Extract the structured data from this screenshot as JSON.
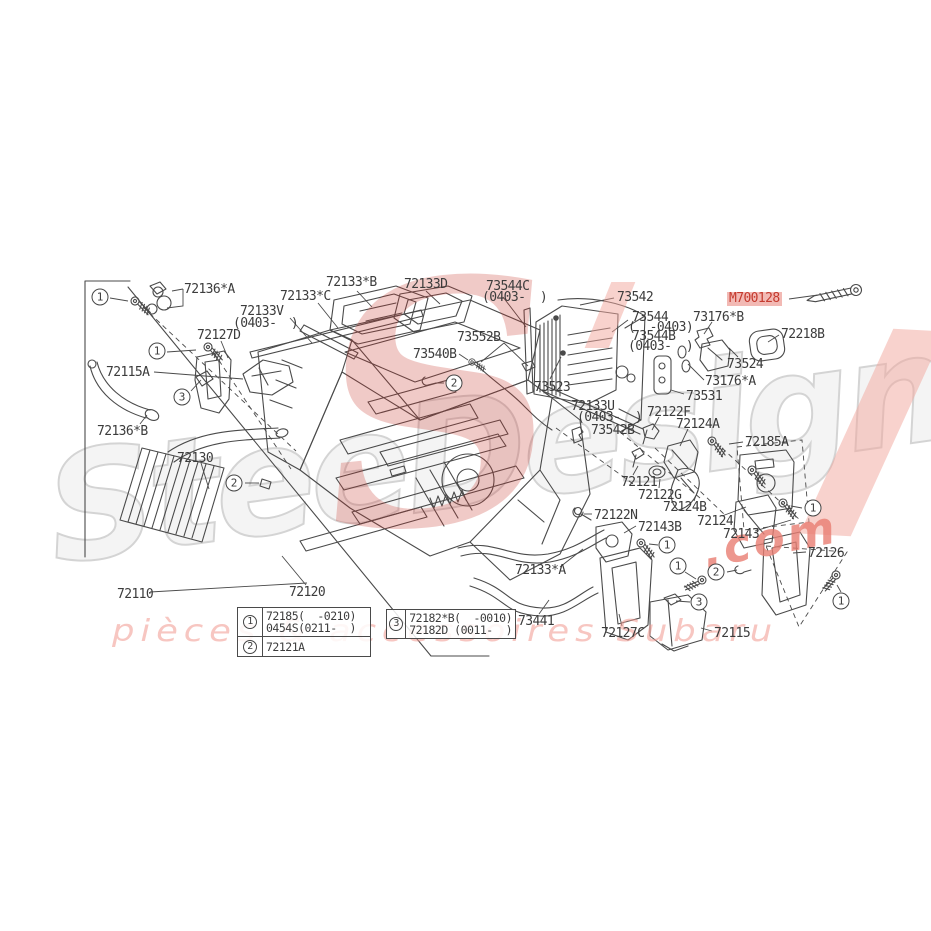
{
  "diagram": {
    "bg": "#ffffff",
    "line_color": "#4a4a4a",
    "label_color": "#3c3c3c",
    "highlight": {
      "part": "M700128",
      "text_color": "#c43a2e",
      "bg_color": "#f2b9b4"
    },
    "part_labels": [
      {
        "text": "72136*A",
        "x": 184,
        "y": 283
      },
      {
        "text": "72133*C",
        "x": 280,
        "y": 290
      },
      {
        "text": "72133*B",
        "x": 326,
        "y": 276
      },
      {
        "text": "72133D",
        "x": 404,
        "y": 278
      },
      {
        "text": "72133V",
        "x": 240,
        "y": 305
      },
      {
        "text": "(0403-  )",
        "x": 233,
        "y": 317
      },
      {
        "text": "72127D",
        "x": 197,
        "y": 329
      },
      {
        "text": "72115A",
        "x": 106,
        "y": 366
      },
      {
        "text": "72136*B",
        "x": 97,
        "y": 425
      },
      {
        "text": "72130",
        "x": 177,
        "y": 452
      },
      {
        "text": "72110",
        "x": 117,
        "y": 588
      },
      {
        "text": "72120",
        "x": 289,
        "y": 586
      },
      {
        "text": "73544C",
        "x": 486,
        "y": 280
      },
      {
        "text": "(0403-  )",
        "x": 482,
        "y": 291
      },
      {
        "text": "73542",
        "x": 617,
        "y": 291
      },
      {
        "text": "73552B",
        "x": 457,
        "y": 331
      },
      {
        "text": "73540B",
        "x": 413,
        "y": 348
      },
      {
        "text": "73523",
        "x": 534,
        "y": 381
      },
      {
        "text": "72133U",
        "x": 571,
        "y": 400
      },
      {
        "text": "(0403-  )",
        "x": 577,
        "y": 411
      },
      {
        "text": "73542B",
        "x": 591,
        "y": 424
      },
      {
        "text": "M700128",
        "x": 727,
        "y": 292,
        "highlight": true
      },
      {
        "text": "72218B",
        "x": 781,
        "y": 328
      },
      {
        "text": "73544",
        "x": 632,
        "y": 311
      },
      {
        "text": "(  -0403)",
        "x": 628,
        "y": 321
      },
      {
        "text": "73544B",
        "x": 632,
        "y": 330
      },
      {
        "text": "(0403-  )",
        "x": 628,
        "y": 340
      },
      {
        "text": "73176*B",
        "x": 693,
        "y": 311
      },
      {
        "text": "73524",
        "x": 727,
        "y": 358
      },
      {
        "text": "73176*A",
        "x": 705,
        "y": 375
      },
      {
        "text": "73531",
        "x": 686,
        "y": 390
      },
      {
        "text": "72122F",
        "x": 647,
        "y": 406
      },
      {
        "text": "72124A",
        "x": 676,
        "y": 418
      },
      {
        "text": "72185A",
        "x": 745,
        "y": 436
      },
      {
        "text": "72121",
        "x": 621,
        "y": 476
      },
      {
        "text": "72122G",
        "x": 638,
        "y": 489
      },
      {
        "text": "72124B",
        "x": 663,
        "y": 501
      },
      {
        "text": "72124",
        "x": 697,
        "y": 515
      },
      {
        "text": "72143",
        "x": 723,
        "y": 528
      },
      {
        "text": "72122N",
        "x": 594,
        "y": 509
      },
      {
        "text": "72143B",
        "x": 638,
        "y": 521
      },
      {
        "text": "72126",
        "x": 808,
        "y": 547
      },
      {
        "text": "72133*A",
        "x": 515,
        "y": 564
      },
      {
        "text": "73441",
        "x": 518,
        "y": 615
      },
      {
        "text": "72127C",
        "x": 601,
        "y": 627
      },
      {
        "text": "72115",
        "x": 714,
        "y": 627
      }
    ],
    "callouts": [
      {
        "num": "1",
        "x": 100,
        "y": 297
      },
      {
        "num": "1",
        "x": 157,
        "y": 351
      },
      {
        "num": "3",
        "x": 182,
        "y": 397
      },
      {
        "num": "2",
        "x": 234,
        "y": 483
      },
      {
        "num": "2",
        "x": 454,
        "y": 383
      },
      {
        "num": "1",
        "x": 813,
        "y": 508
      },
      {
        "num": "1",
        "x": 667,
        "y": 545
      },
      {
        "num": "1",
        "x": 678,
        "y": 566
      },
      {
        "num": "2",
        "x": 716,
        "y": 572
      },
      {
        "num": "3",
        "x": 699,
        "y": 602
      },
      {
        "num": "1",
        "x": 841,
        "y": 601
      }
    ]
  },
  "legend_table": {
    "left_rows": [
      {
        "badge": "1",
        "lines": [
          "72185(  -0210)",
          "0454S(0211-  )"
        ]
      },
      {
        "badge": "2",
        "lines": [
          "72121A"
        ]
      }
    ],
    "right_rows": [
      {
        "badge": "3",
        "lines": [
          "72182*B(  -0010)",
          "72182D (0011-  )"
        ]
      }
    ]
  },
  "watermark": {
    "brand": "SteeDesign",
    "suffix": ".com",
    "tagline": "pièces & accessoires Subaru",
    "outline_color": "#d4d4d4",
    "pink": "#ef9f96",
    "red": "#c9362c"
  }
}
